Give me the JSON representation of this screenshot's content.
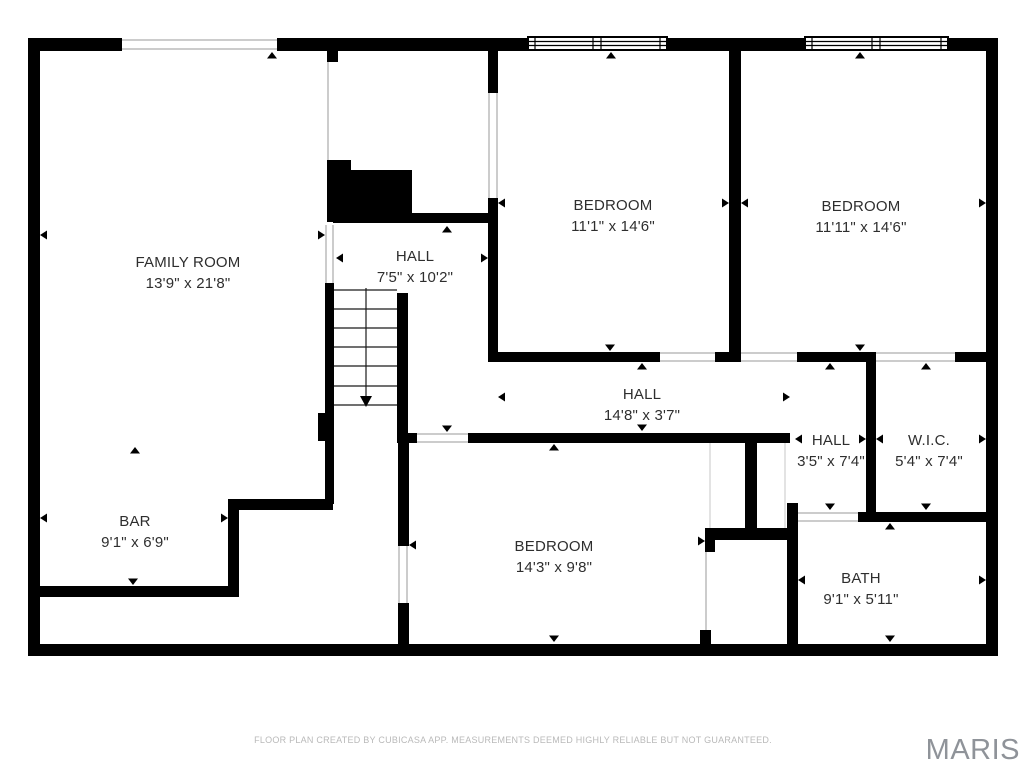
{
  "rooms": [
    {
      "id": "family-room",
      "name": "FAMILY ROOM",
      "size": "13'9\" x 21'8\""
    },
    {
      "id": "hall-upper",
      "name": "HALL",
      "size": "7'5\" x 10'2\""
    },
    {
      "id": "bedroom-top-middle",
      "name": "BEDROOM",
      "size": "11'1\" x 14'6\""
    },
    {
      "id": "bedroom-top-right",
      "name": "BEDROOM",
      "size": "11'11\" x 14'6\""
    },
    {
      "id": "hall-middle",
      "name": "HALL",
      "size": "14'8\" x 3'7\""
    },
    {
      "id": "hall-small",
      "name": "HALL",
      "size": "3'5\" x 7'4\""
    },
    {
      "id": "wic",
      "name": "W.I.C.",
      "size": "5'4\" x 7'4\""
    },
    {
      "id": "bar",
      "name": "BAR",
      "size": "9'1\" x 6'9\""
    },
    {
      "id": "bedroom-bottom",
      "name": "BEDROOM",
      "size": "14'3\" x 9'8\""
    },
    {
      "id": "bath",
      "name": "BATH",
      "size": "9'1\" x 5'11\""
    }
  ],
  "footer": {
    "text": "FLOOR PLAN CREATED BY CUBICASA APP. MEASUREMENTS DEEMED HIGHLY RELIABLE BUT NOT GUARANTEED."
  },
  "watermark": {
    "text": "MARIS"
  },
  "colors": {
    "wall": "#000000",
    "label_text": "#2e2e2e",
    "opening_line": "#9a9a9a",
    "footer_text": "#b9b9b9",
    "watermark_text": "#8f9399",
    "background": "#ffffff"
  }
}
